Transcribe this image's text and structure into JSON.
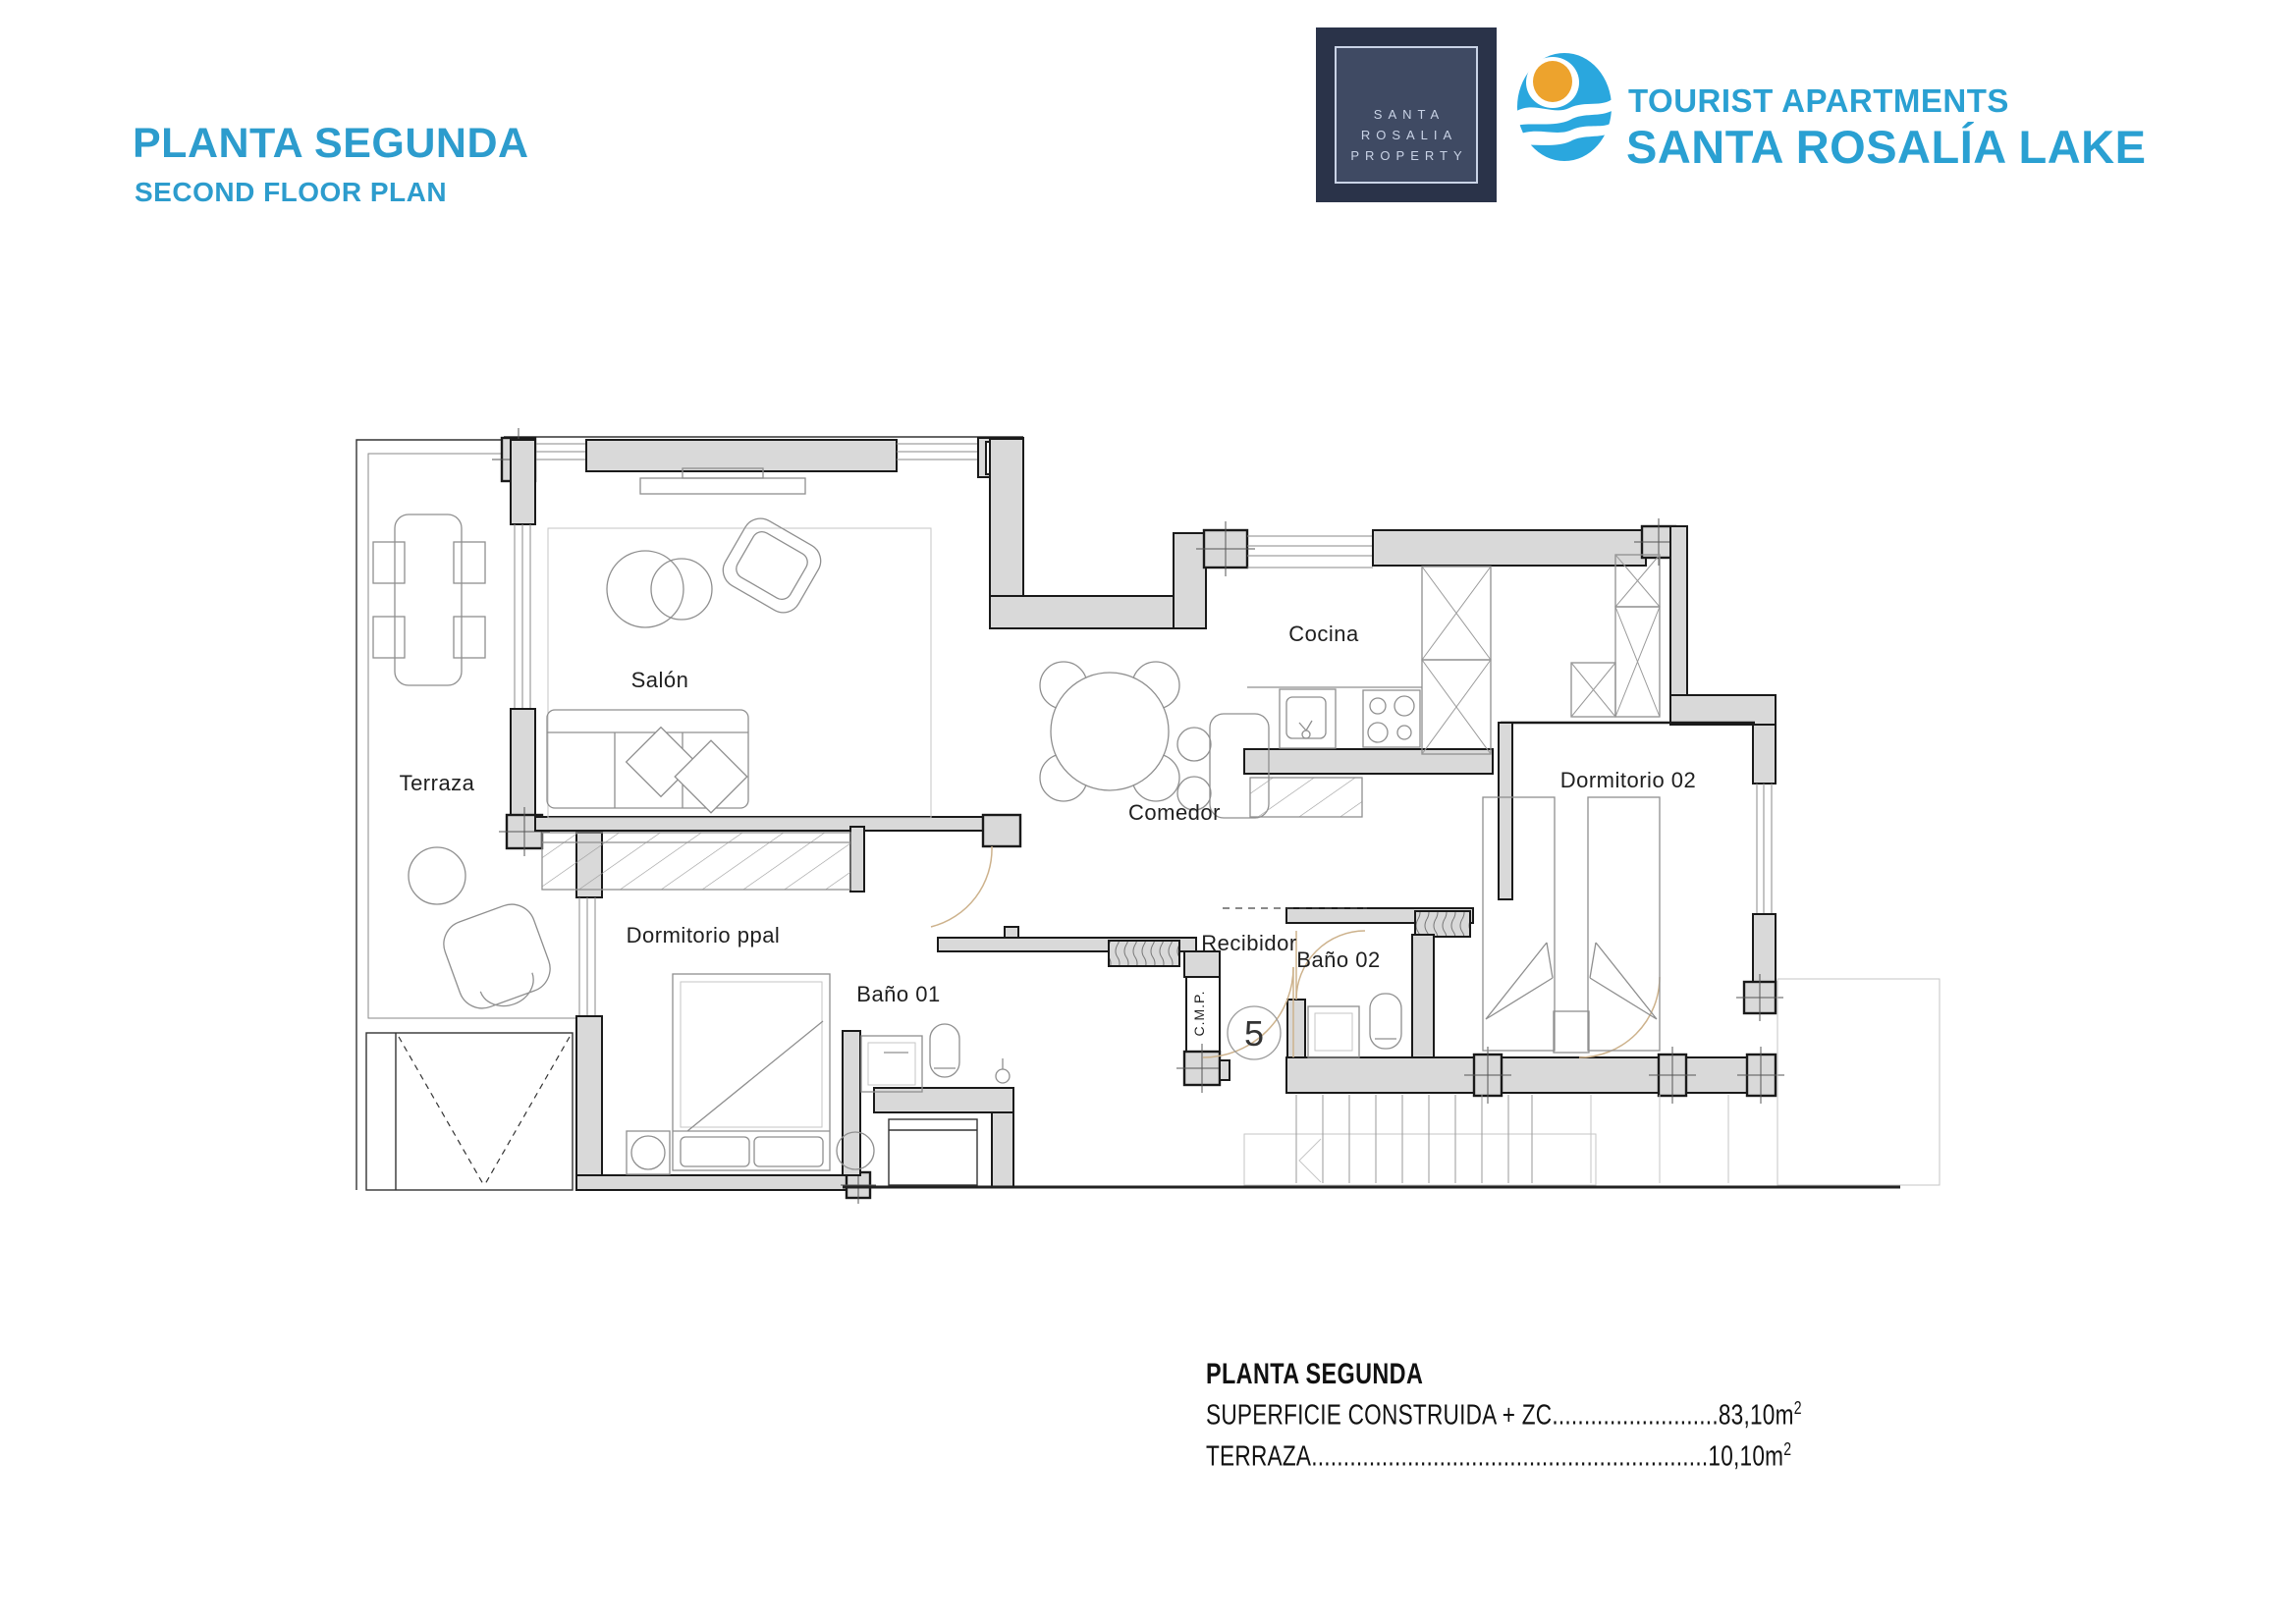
{
  "header": {
    "title": "PLANTA SEGUNDA",
    "subtitle": "SECOND FLOOR PLAN"
  },
  "brand": {
    "property_card": {
      "line1": "SANTA",
      "line2": "ROSALIA",
      "line3": "PROPERTY"
    },
    "name_top": "TOURIST APARTMENTS",
    "name_bottom": "SANTA ROSALÍA LAKE"
  },
  "floorplan": {
    "rooms": {
      "terraza": "Terraza",
      "salon": "Salón",
      "comedor": "Comedor",
      "cocina": "Cocina",
      "dormitorio_ppal": "Dormitorio ppal",
      "dormitorio_02": "Dormitorio 02",
      "bano_01": "Baño 01",
      "bano_02": "Baño 02",
      "recibidor": "Recibidor"
    },
    "unit_number": "5",
    "shaft_label": "C.M.P."
  },
  "summary": {
    "title": "PLANTA SEGUNDA",
    "line1_label": "SUPERFICIE CONSTRUIDA + ZC",
    "line1_dots": "..........................",
    "line1_value": "83,10m",
    "line1_sup": "2",
    "line2_label": "TERRAZA",
    "line2_dots": "..............................................................",
    "line2_value": "10,10m",
    "line2_sup": "2"
  },
  "colors": {
    "accent_blue": "#2d9ccd",
    "brand_blue": "#2aa0d2",
    "navy_card": "#2a3349",
    "wall_grey": "#d9d9d9",
    "door_tan": "#cdb28c",
    "sun_orange": "#eda32d"
  }
}
